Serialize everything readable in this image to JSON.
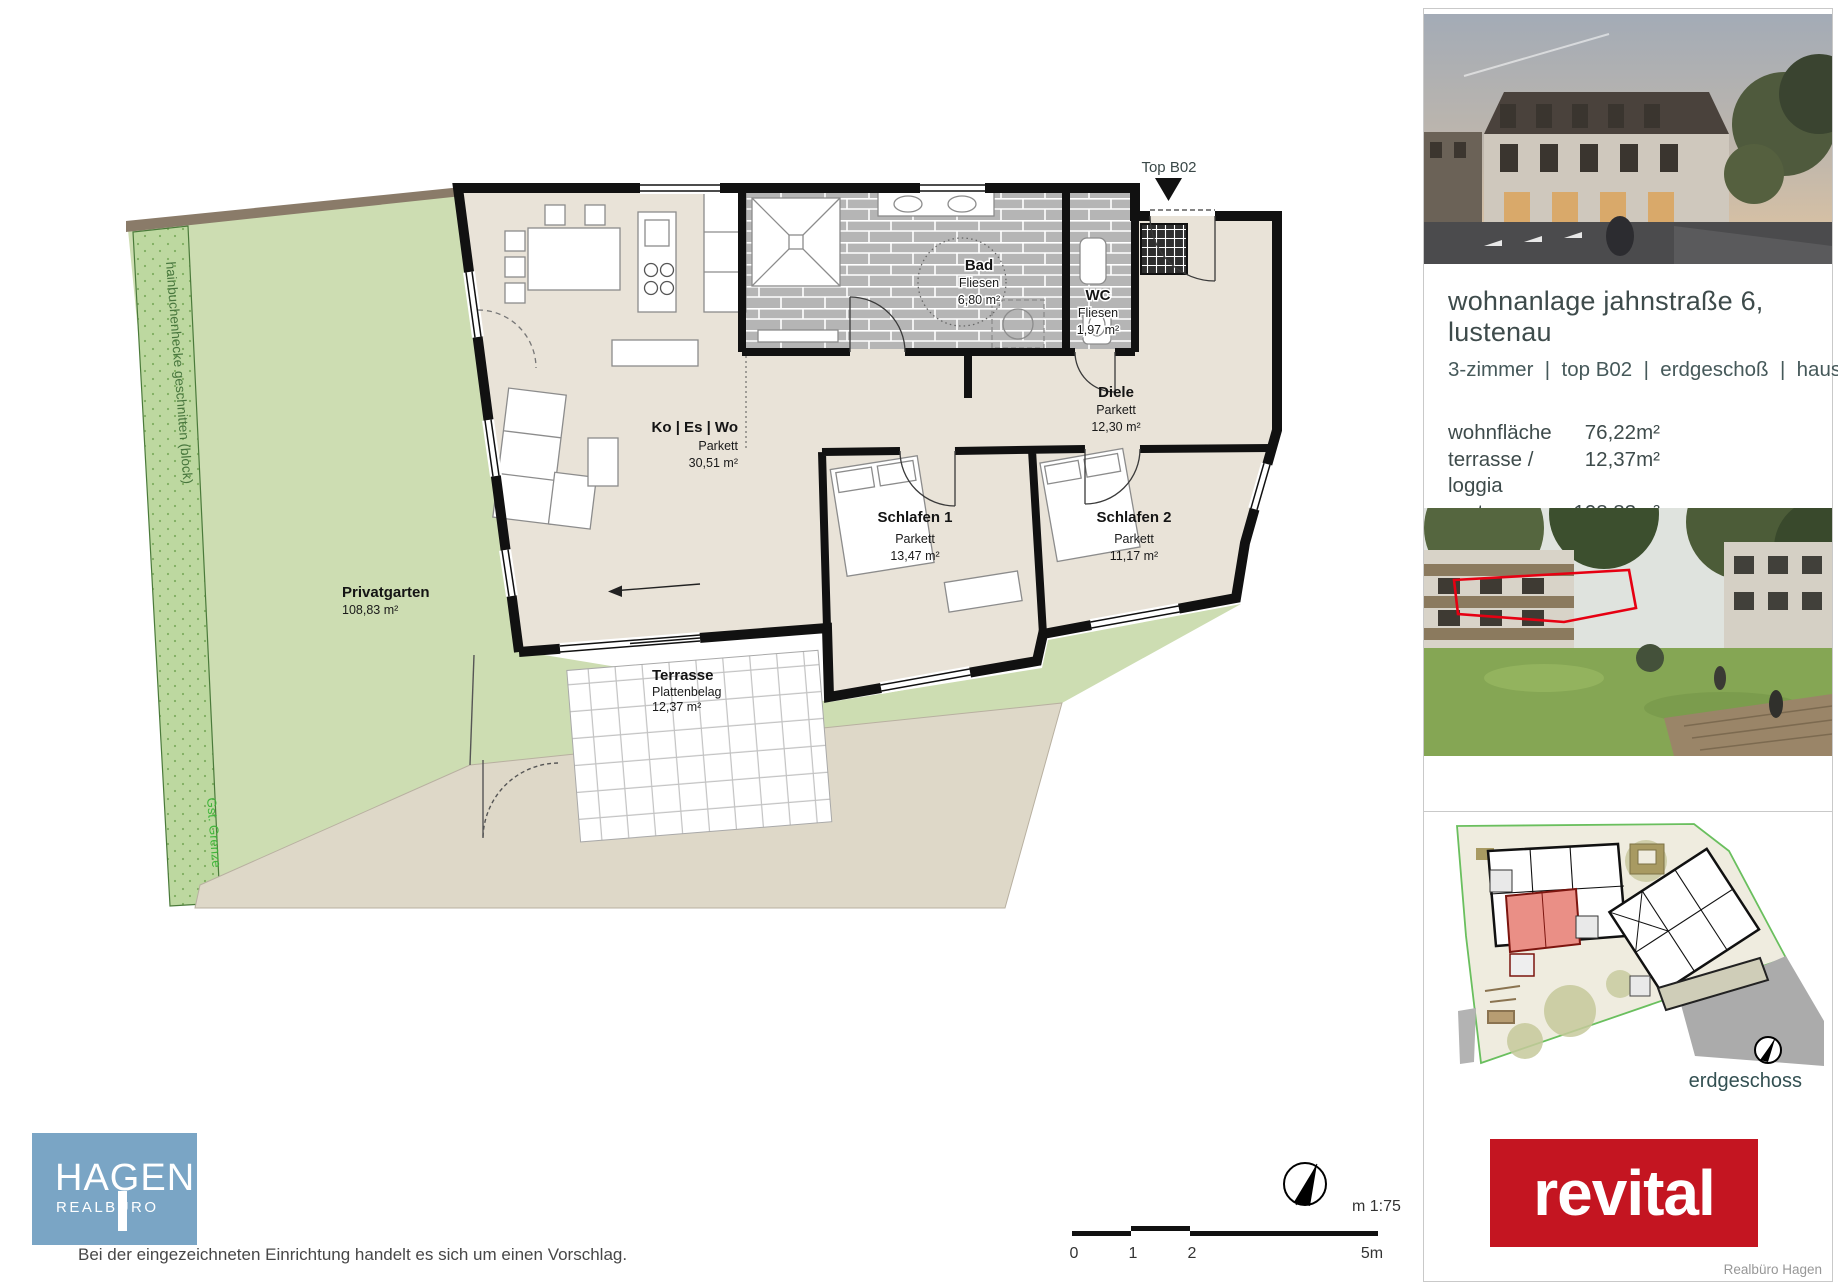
{
  "floor_plan": {
    "entrance_label": "Top B02",
    "rooms": [
      {
        "name": "Ko | Es | Wo",
        "finish": "Parkett",
        "area": "30,51 m²"
      },
      {
        "name": "Bad",
        "finish": "Fliesen",
        "area": "6,80 m²"
      },
      {
        "name": "WC",
        "finish": "Fliesen",
        "area": "1,97 m²"
      },
      {
        "name": "Diele",
        "finish": "Parkett",
        "area": "12,30 m²"
      },
      {
        "name": "Schlafen 1",
        "finish": "Parkett",
        "area": "13,47 m²"
      },
      {
        "name": "Schlafen 2",
        "finish": "Parkett",
        "area": "11,17 m²"
      },
      {
        "name": "Terrasse",
        "finish": "Plattenbelag",
        "area": "12,37 m²"
      },
      {
        "name": "Privatgarten",
        "finish": "",
        "area": "108,83 m²"
      }
    ],
    "hedge_label": "hainbuchenhecke geschnitten (block)",
    "boundary_label": "Gst. Grenze",
    "scale_label": "m 1:75",
    "scale_ticks": [
      "0",
      "1",
      "2",
      "5m"
    ]
  },
  "sidebar": {
    "title": "wohnanlage jahnstraße 6, lustenau",
    "subtitle": "3-zimmer  |  top B02  |  erdgeschoß  |  haus B",
    "areas": [
      {
        "label": "wohnfläche",
        "value": "76,22m²"
      },
      {
        "label": "terrasse / loggia",
        "value": "12,37m²"
      },
      {
        "label": "garten",
        "value": "108,83m²"
      },
      {
        "label": "kellerabteil B02",
        "value": "7,18m²"
      },
      {
        "label": "nutzbare fläche",
        "value": "204,60m²"
      }
    ],
    "siteplan_caption": "erdgeschoss",
    "brand_logo": "revital",
    "credit": "Realbüro Hagen"
  },
  "footer": {
    "agency_name": "HAGEN",
    "agency_sub": "REALBÜRO",
    "disclaimer": "Bei der eingezeichneten Einrichtung handelt es sich um einen Vorschlag."
  },
  "colors": {
    "accent_red": "#c41521",
    "hagen_blue": "#7aa5c5",
    "garden_green": "#cdddb2",
    "hedge_green": "#bdd8a0",
    "plan_floor": "#e9e3d8",
    "wall_black": "#111111",
    "tile_gray": "#b5b5b5",
    "ground_beige": "#ded8c8",
    "site_boundary_green": "#6abf5e",
    "unit_highlight": "#ea8f86",
    "text_dark": "#3e4b4b"
  }
}
